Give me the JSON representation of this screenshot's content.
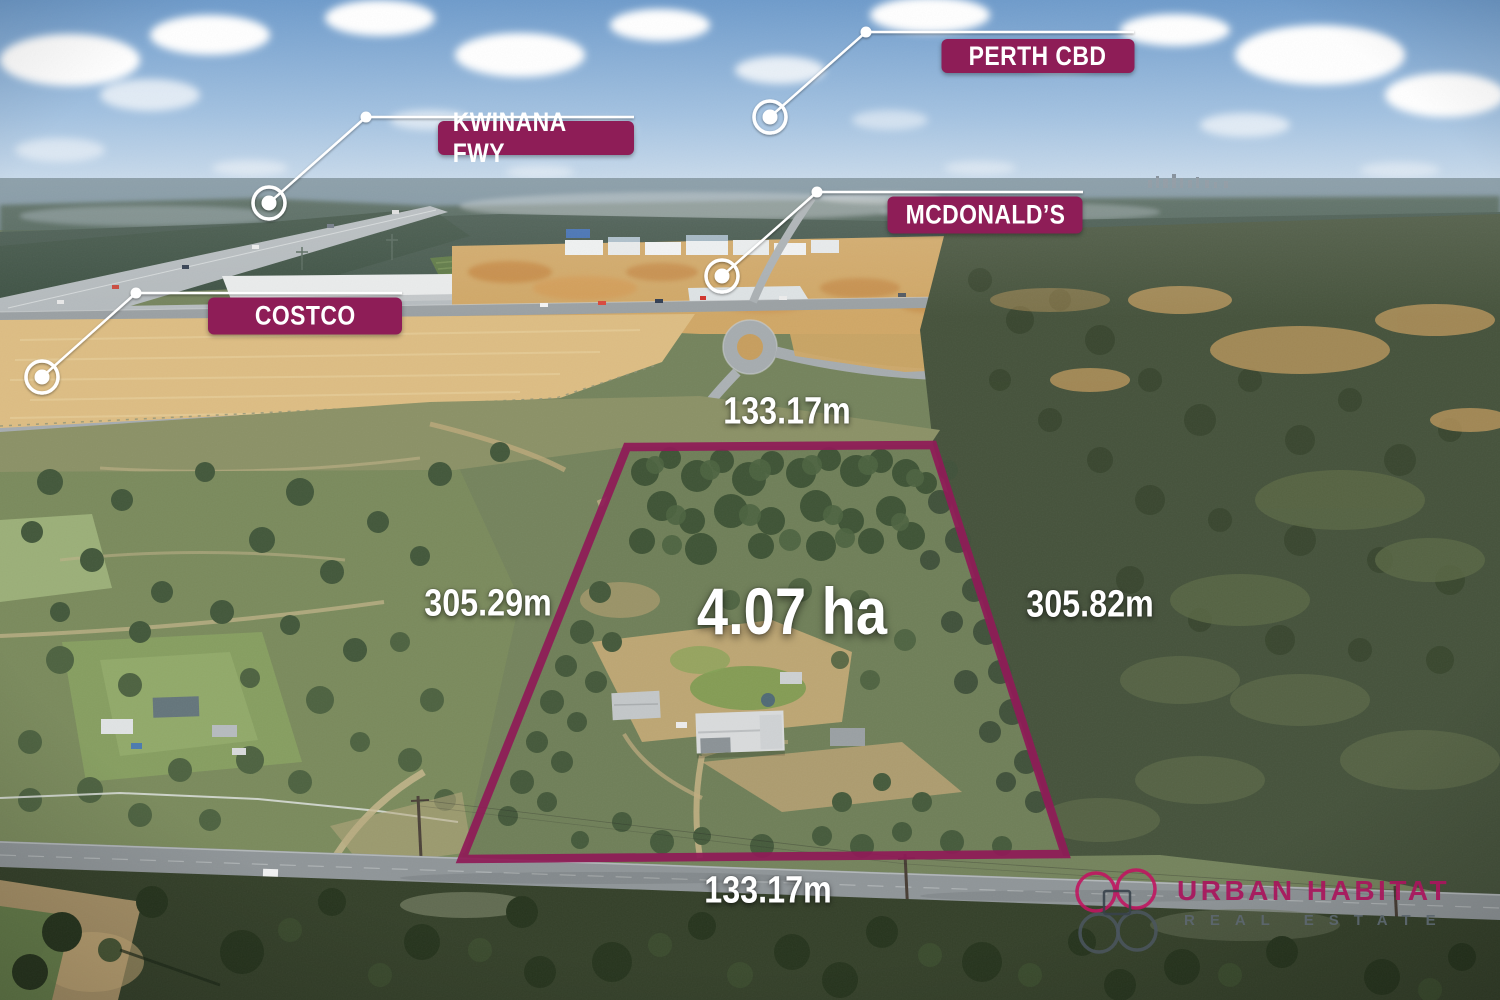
{
  "colors": {
    "accent_magenta": "#8e1d57",
    "boundary_magenta": "#8f1b57",
    "callout_line_white": "#ffffff",
    "logo_magenta": "#c01660",
    "logo_gray": "#4b565f"
  },
  "callouts": [
    {
      "label": "PERTH CBD"
    },
    {
      "label": "KWINANA FWY"
    },
    {
      "label": "MCDONALD’S"
    },
    {
      "label": "COSTCO"
    }
  ],
  "property": {
    "area": "4.07 ha",
    "top": "133.17m",
    "left": "305.29m",
    "right": "305.82m",
    "bottom": "133.17m"
  },
  "brand": {
    "name": "URBAN HABITAT",
    "tagline": "REAL ESTATE"
  }
}
